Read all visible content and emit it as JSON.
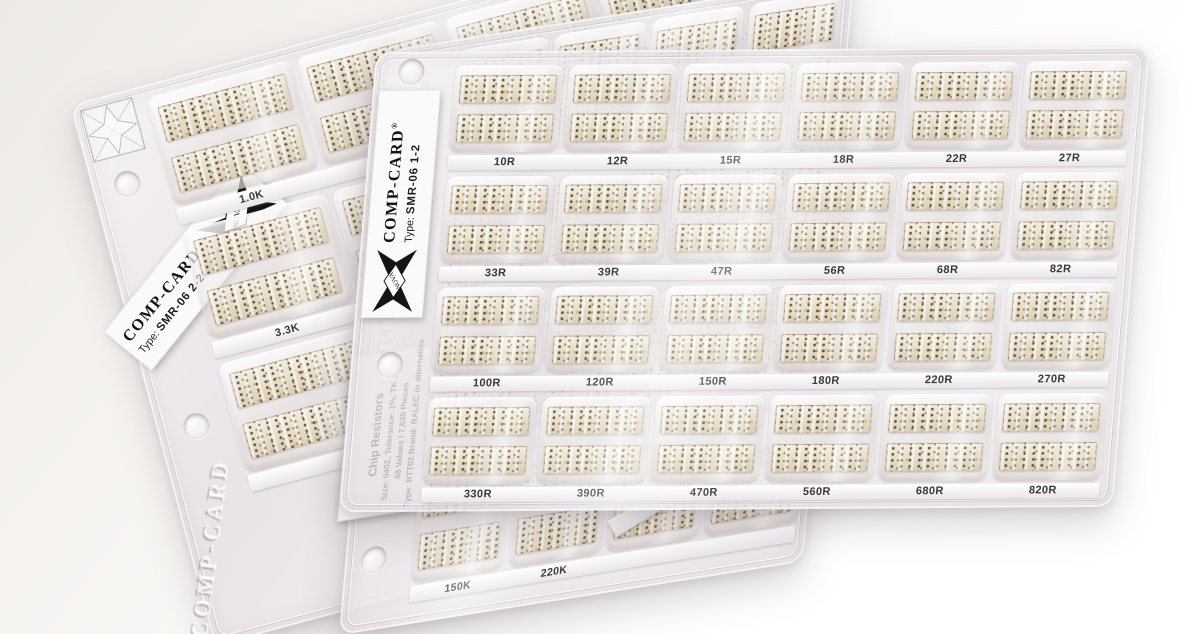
{
  "brand": {
    "name": "COMP-CARD",
    "reg": "®",
    "logo_text": "NOVA"
  },
  "top_card": {
    "brand": "COMP-CARD",
    "reg": "®",
    "type_label": "Type:",
    "type_value": "SMR-06 1-2",
    "rows": [
      {
        "labels": [
          "10R",
          "12R",
          "15R",
          "18R",
          "22R",
          "27R"
        ]
      },
      {
        "labels": [
          "33R",
          "39R",
          "47R",
          "56R",
          "68R",
          "82R"
        ]
      },
      {
        "labels": [
          "100R",
          "120R",
          "150R",
          "180R",
          "220R",
          "270R"
        ]
      },
      {
        "labels": [
          "330R",
          "390R",
          "470R",
          "560R",
          "680R",
          "820R"
        ]
      }
    ]
  },
  "middle_card": {
    "embossed_brand": "COMP-CARD",
    "info_label": {
      "line1": "Chip Resistors",
      "line2": "Size: 0402, Tolerance: 1%, TK 100",
      "line3": "48 Values / 7,830 Pieces",
      "line4": "Type: RTT02 Brand: RALEC or alternative"
    },
    "bottom_row_labels": [
      "150K",
      "220K"
    ]
  },
  "back_card": {
    "brand": "COMP-CARD",
    "reg": "®",
    "type_label": "Type:",
    "type_value": "SMR-06 2-2",
    "row1_labels": [
      "1.0K",
      "1.2K"
    ],
    "row2_labels": [
      "3.3K"
    ],
    "embossed_brand": "COMP-CARD"
  },
  "peek_strip_label": "330R"
}
